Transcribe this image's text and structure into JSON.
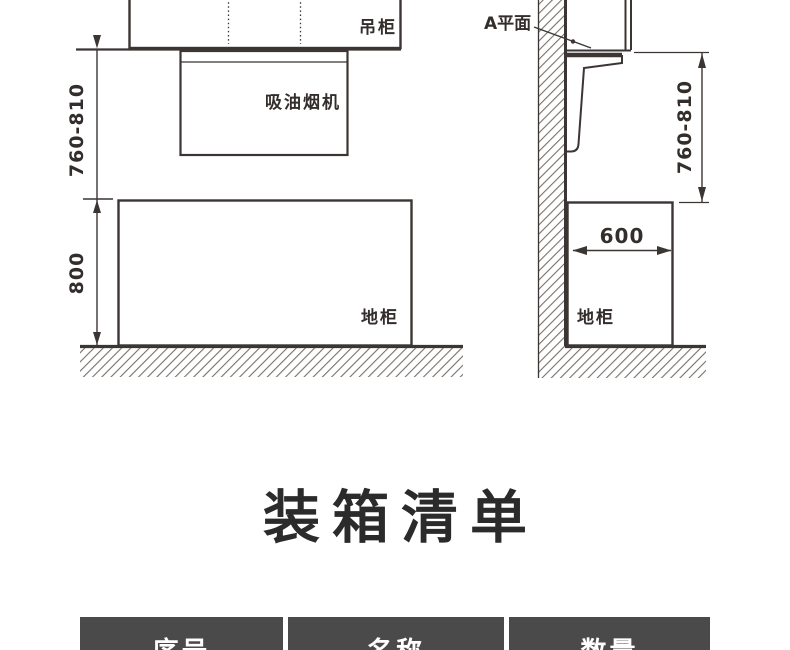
{
  "colors": {
    "line": "#3b3533",
    "hatch": "#77716c",
    "title_text": "#2b2b2b",
    "table_header_bg": "#4a4a4a",
    "table_header_text": "#ffffff"
  },
  "diagram": {
    "front_view": {
      "wall_cabinet_label": "吊柜",
      "hood_label": "吸油烟机",
      "base_cabinet_label": "地柜",
      "hood_height_dim": "760-810",
      "base_cabinet_height_dim": "800"
    },
    "side_view": {
      "plane_label": "A平面",
      "base_cabinet_label": "地柜",
      "hood_height_dim": "760-810",
      "base_cabinet_depth_dim": "600"
    }
  },
  "packing_list": {
    "title": "装箱清单",
    "table_headers": [
      "序号",
      "名称",
      "数量"
    ]
  }
}
